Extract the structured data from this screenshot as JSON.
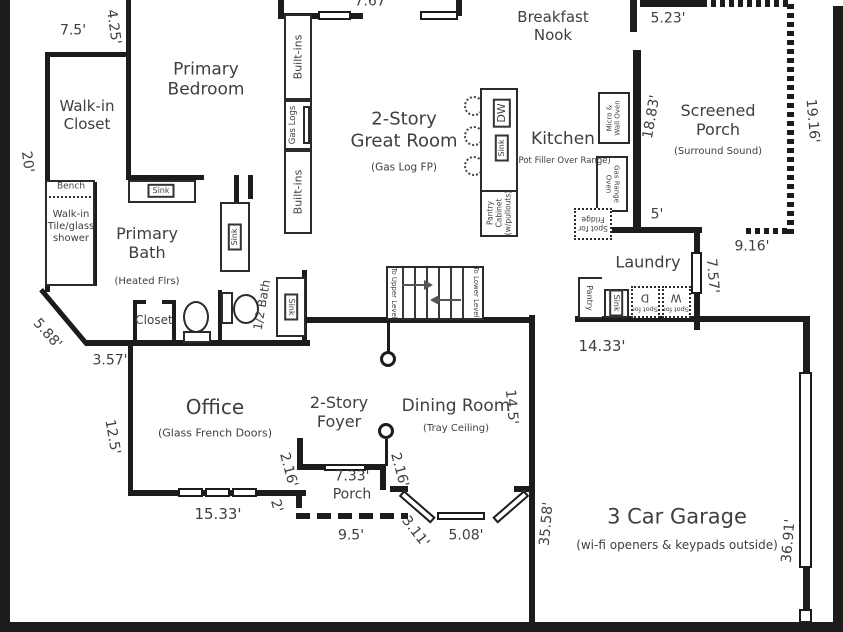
{
  "colors": {
    "wall": "#1c1c1c",
    "text": "#3f3f3f",
    "background": "#ffffff"
  },
  "plan": {
    "rooms": {
      "primary_bedroom": {
        "l1": "Primary",
        "l2": "Bedroom"
      },
      "walk_in_closet": {
        "l1": "Walk-in",
        "l2": "Closet"
      },
      "primary_bath": {
        "l1": "Primary",
        "l2": "Bath",
        "sub": "(Heated Flrs)"
      },
      "shower": {
        "l1": "Walk-in",
        "l2": "Tile/glass",
        "l3": "shower"
      },
      "bath_closet": {
        "name": "Closet"
      },
      "half_bath": {
        "name": "1/2 Bath"
      },
      "office": {
        "name": "Office",
        "sub": "(Glass French Doors)"
      },
      "foyer": {
        "l1": "2-Story",
        "l2": "Foyer"
      },
      "front_porch": {
        "name": "Porch"
      },
      "dining_room": {
        "name": "Dining Room",
        "sub": "(Tray Ceiling)"
      },
      "garage": {
        "name": "3 Car Garage",
        "sub": "(wi-fi openers & keypads outside)"
      },
      "laundry": {
        "name": "Laundry"
      },
      "great_room": {
        "l1": "2-Story",
        "l2": "Great Room",
        "sub": "(Gas Log FP)"
      },
      "kitchen": {
        "name": "Kitchen",
        "sub": "(Pot Filler Over Range)"
      },
      "breakfast_nook": {
        "l1": "Breakfast",
        "l2": "Nook"
      },
      "screened_porch": {
        "l1": "Screened",
        "l2": "Porch",
        "sub": "(Surround Sound)"
      }
    },
    "dimensions": {
      "top_opening": "7.67'",
      "closet_top": "7.5'",
      "closet_step": "4.25'",
      "left_wall": "20'",
      "diag_wall": "5.88'",
      "bath_bottom": "3.57'",
      "office_left": "12.5'",
      "office_bottom": "15.33'",
      "porch_step": "2'",
      "foyer_left": "2.16'",
      "porch_width": "7.33'",
      "porch_front": "9.5'",
      "foyer_right": "2.16'",
      "bay_left": "3.11'",
      "bay_front": "5.08'",
      "dining_right": "14.5'",
      "garage_left": "35.58'",
      "garage_right": "36.91'",
      "garage_top": "14.33'",
      "laundry_right": "7.57'",
      "porch_bottom": "9.16'",
      "porch_step2": "5'",
      "nook_right": "5.23'",
      "kitchen_wall": "18.83'",
      "screened_right": "19.16'"
    },
    "fixtures": {
      "sink": "Sink",
      "dw": "DW",
      "bench": "Bench",
      "built_ins": "Built-ins",
      "gas_logs": "Gas Logs",
      "pantry": "Pantry",
      "pantry_cabinet": {
        "l1": "Pantry",
        "l2": "Cabinet",
        "l3": "(w/pullouts)"
      },
      "micro_wall_oven": {
        "l1": "Micro &",
        "l2": "Wall Oven"
      },
      "gas_range": {
        "l1": "Gas Range",
        "l2": "Oven"
      },
      "spot_fridge": {
        "l1": "Spot for",
        "l2": "Fridge"
      },
      "spot_dryer": {
        "l1": "Spot for",
        "l2": "D"
      },
      "spot_washer": {
        "l1": "Spot for",
        "l2": "W"
      },
      "to_upper": "To Upper Level",
      "to_lower": "To Lower Level"
    }
  }
}
